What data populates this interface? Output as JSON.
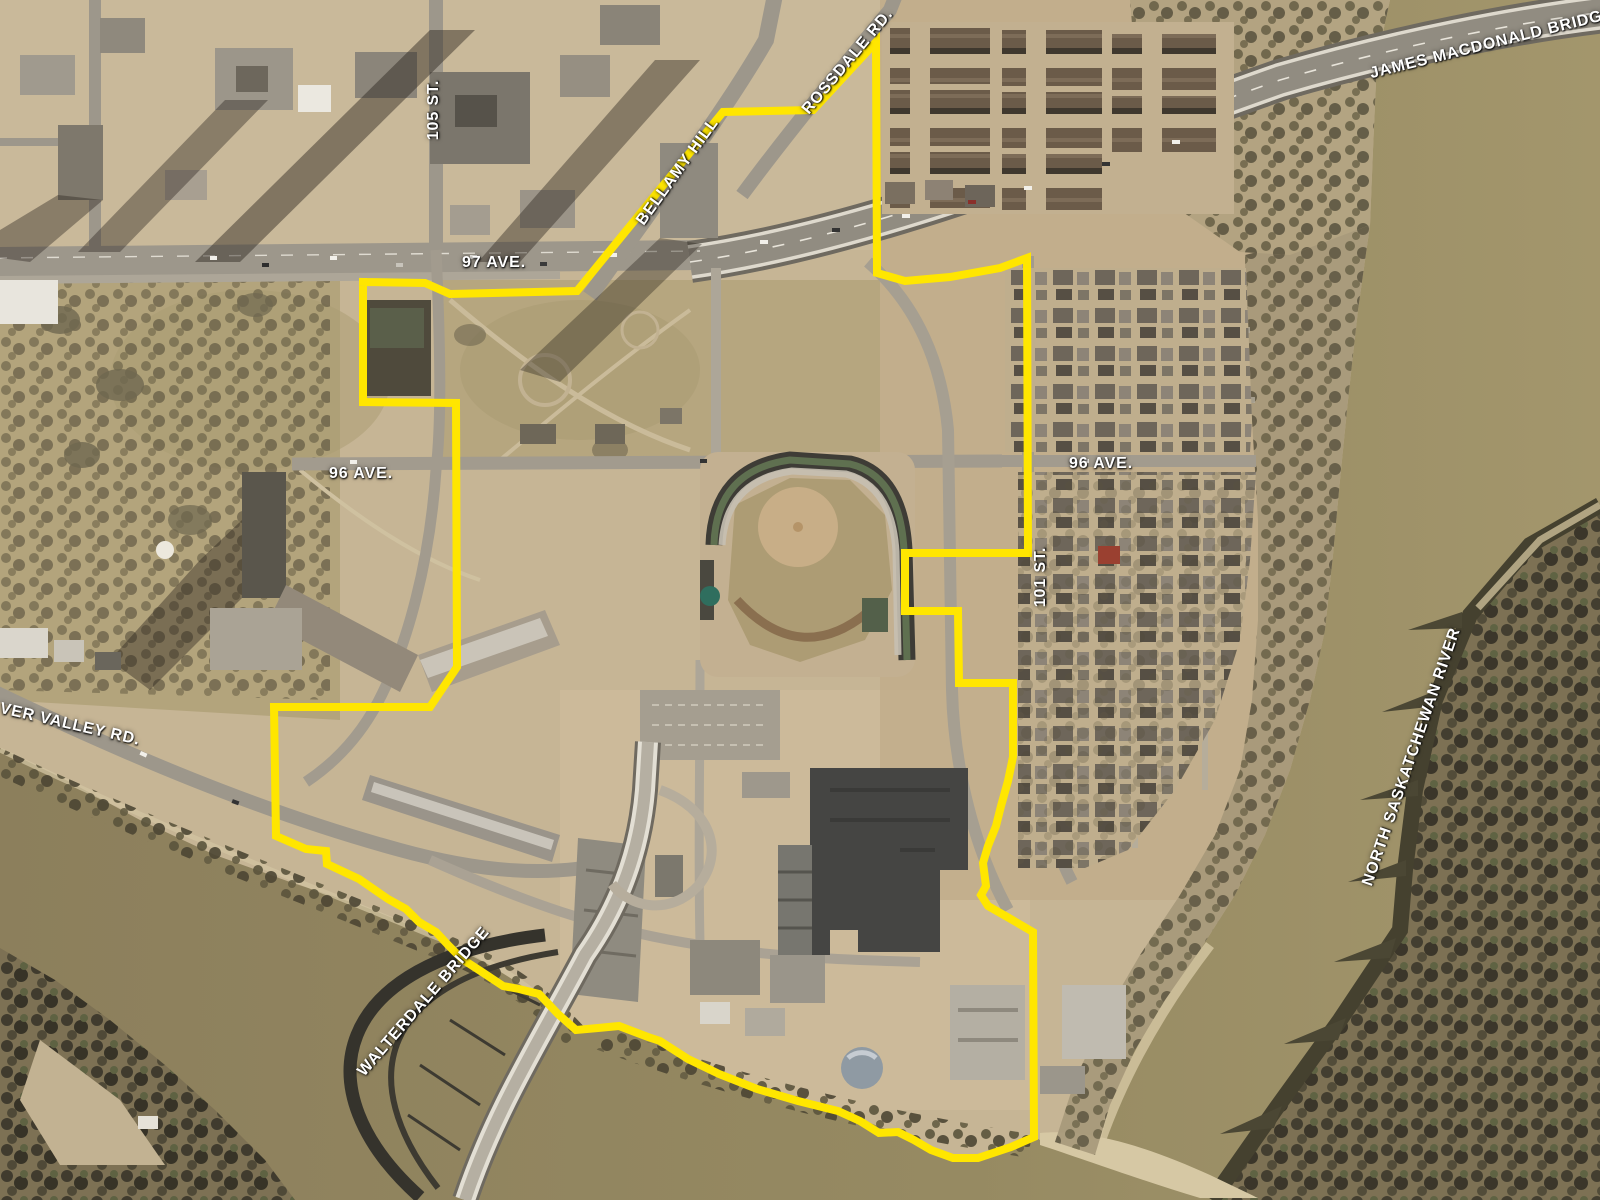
{
  "map": {
    "labels": {
      "st105": "105 ST.",
      "ave97": "97 AVE.",
      "bellamy": "BELLAMY HILL",
      "rossdale": "ROSSDALE RD.",
      "jamesmac": "JAMES MACDONALD BRIDGE",
      "ave96_west": "96 AVE.",
      "ave96_east": "96 AVE.",
      "st101": "101 ST.",
      "rivervalley": "VER VALLEY RD.",
      "walterdale": "WALTERDALE BRIDGE",
      "river": "NORTH SASKATCHEWAN RIVER"
    },
    "boundary": {
      "points": "363,282 425,283 450,294 577,291 723,112 813,110 876,42 877,273 905,281 950,277 1000,268 1027,258 1028,553 905,553 905,611 958,611 959,683 1013,683 1013,757 1008,781 1001,806 996,826 988,846 983,863 986,886 981,895 988,906 1009,918 1033,932 1034,1137 1011,1147 978,1158 953,1158 931,1150 914,1140 898,1132 879,1133 860,1121 838,1111 798,1101 757,1089 719,1074 688,1059 660,1041 648,1037 619,1026 598,1028 576,1030 558,1014 539,994 519,989 503,986 482,972 462,959 449,946 436,932 419,922 406,909 388,899 359,879 327,864 326,851 306,849 276,836 274,707 430,707 457,667 456,403 363,402 363,282"
    },
    "colors": {
      "boundary": "#ffe600",
      "label": "#ffffff",
      "water": "#92855f",
      "water2": "#a3966c",
      "land": "#c6b595",
      "forest": "#7d7154",
      "road": "#9d978b",
      "sand": "#d6c8a4"
    }
  }
}
